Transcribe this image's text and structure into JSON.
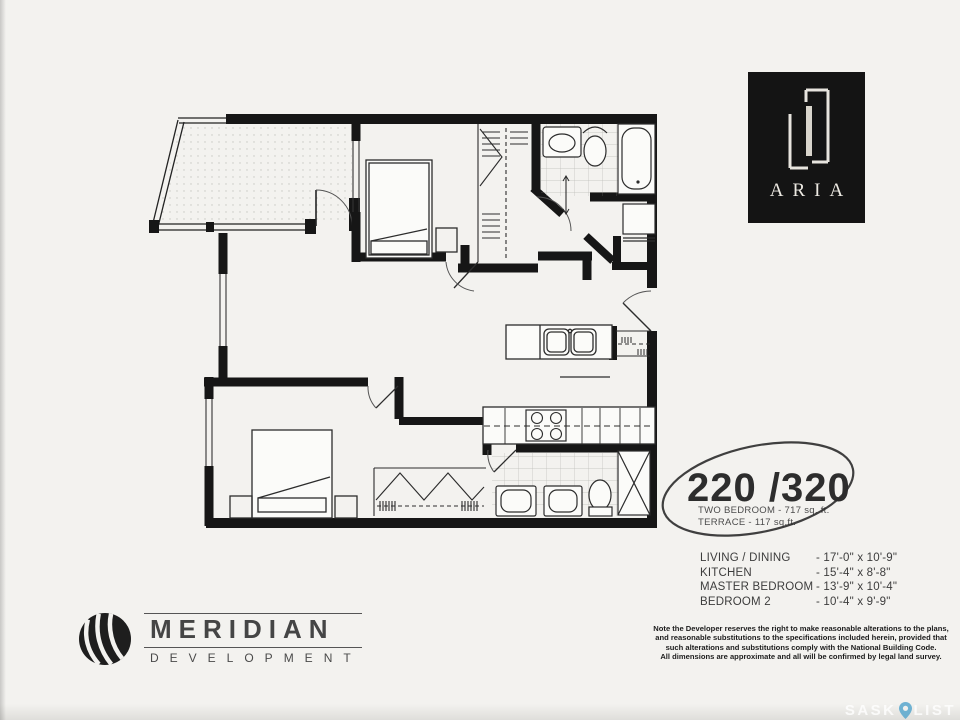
{
  "page": {
    "paper_color": "#f3f2ef",
    "ink_color": "#161616"
  },
  "aria_logo": {
    "label": "ARIA",
    "bg": "#141414"
  },
  "unit": {
    "number": "220 /320",
    "type_line": "TWO BEDROOM - 717 sq. ft.",
    "terrace_line": "TERRACE - 117 sq.ft."
  },
  "dimensions": {
    "rows": [
      {
        "room": "LIVING / DINING",
        "size": "-  17'-0\" x 10'-9\""
      },
      {
        "room": "KITCHEN",
        "size": "-  15'-4\" x 8'-8\""
      },
      {
        "room": "MASTER BEDROOM",
        "size": "-  13'-9\" x 10'-4\""
      },
      {
        "room": "BEDROOM 2",
        "size": "-  10'-4\" x 9'-9\""
      }
    ]
  },
  "disclaimer": {
    "lines": [
      "Note the Developer reserves the right to make reasonable alterations to the plans,",
      "and reasonable substitutions to the specifications included herein, provided that",
      "such alterations and substitutions comply with the National Building Code.",
      "All dimensions are approximate and all will be confirmed by legal land survey."
    ]
  },
  "developer_logo": {
    "name": "MERIDIAN",
    "subtitle": "DEVELOPMENT"
  },
  "watermark": {
    "prefix": "SASK",
    "suffix": "LIST",
    "pin_color": "#53a5cd"
  }
}
